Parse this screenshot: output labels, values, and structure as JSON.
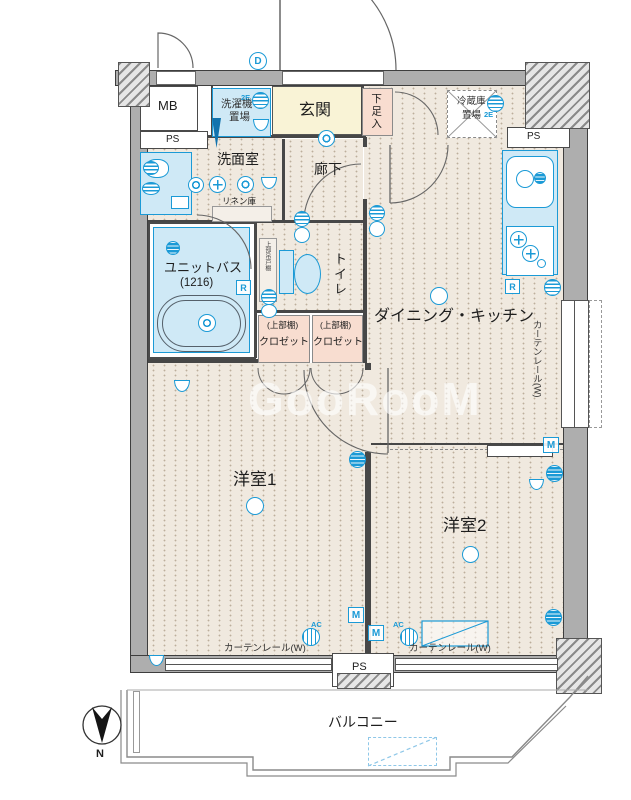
{
  "watermark": "GooRooM",
  "compass": {
    "north": "N"
  },
  "labels": {
    "mb": "MB",
    "ps": "PS",
    "laundry1": "洗濯機",
    "laundry2": "置場",
    "genkan": "玄関",
    "shoe": "下足入",
    "fridge1": "冷蔵庫",
    "fridge2": "置場",
    "washroom": "洗面室",
    "corridor": "廊下",
    "linen": "リネン庫",
    "bath": "ユニットバス",
    "bath_size": "(1216)",
    "toilet": "トイレ",
    "cabinet": "上部吊戸棚",
    "shelf": "(上部棚)",
    "closet": "クロゼット",
    "dk": "ダイニング・キッチン",
    "room1": "洋室1",
    "room2": "洋室2",
    "balcony": "バルコニー",
    "curtain": "カーテンレール(W)"
  },
  "badges": {
    "d": "D",
    "e": "2E",
    "r": "R",
    "m": "M",
    "ac": "AC"
  },
  "colors": {
    "symbol_blue": "#1b9ad6",
    "fixture_fill": "#cfe9f6",
    "genkan_fill": "#f9f3d6",
    "closet_fill": "#f8ddd0",
    "wall_gray": "#aeaeae",
    "floor_beige": "#f0e9df"
  }
}
